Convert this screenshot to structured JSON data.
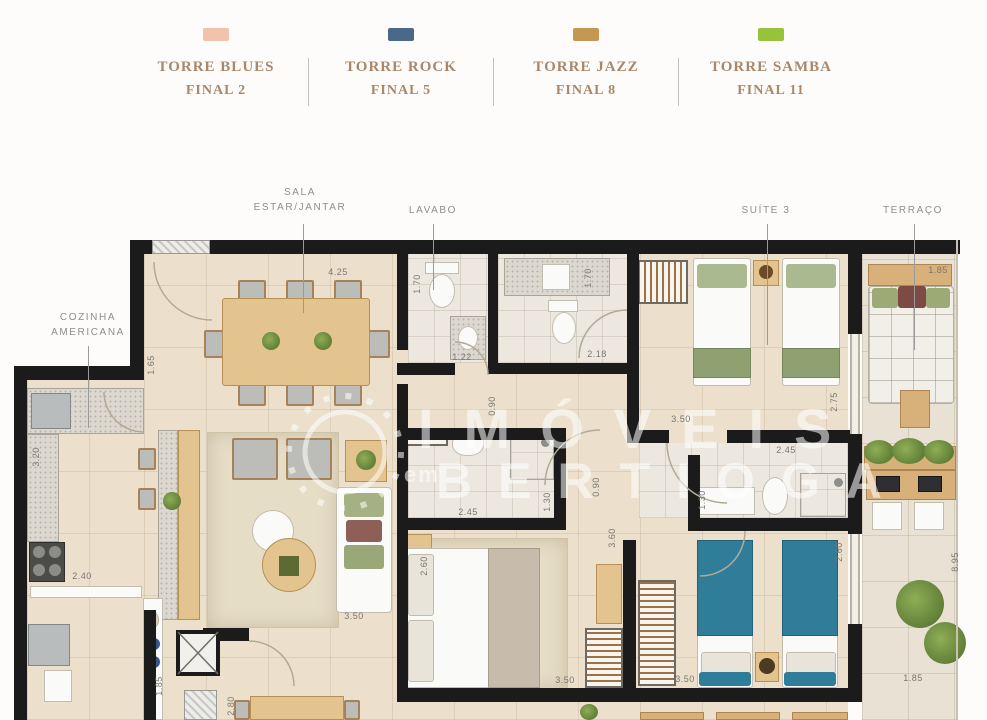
{
  "legend": {
    "items": [
      {
        "name": "TORRE BLUES",
        "final": "FINAL 2",
        "color": "#f1c2ac"
      },
      {
        "name": "TORRE ROCK",
        "final": "FINAL 5",
        "color": "#49688a"
      },
      {
        "name": "TORRE JAZZ",
        "final": "FINAL 8",
        "color": "#c49752"
      },
      {
        "name": "TORRE SAMBA",
        "final": "FINAL 11",
        "color": "#97c23c"
      }
    ]
  },
  "room_labels": [
    {
      "line1": "SALA",
      "line2": "ESTAR/JANTAR",
      "x": 300,
      "y": 185,
      "lx": 303,
      "ly1": 224,
      "ly2": 313
    },
    {
      "line1": "LAVABO",
      "line2": "",
      "x": 433,
      "y": 203,
      "lx": 433,
      "ly1": 224,
      "ly2": 290
    },
    {
      "line1": "SUÍTE 3",
      "line2": "",
      "x": 766,
      "y": 203,
      "lx": 767,
      "ly1": 224,
      "ly2": 345
    },
    {
      "line1": "TERRAÇO",
      "line2": "",
      "x": 913,
      "y": 203,
      "lx": 914,
      "ly1": 224,
      "ly2": 350
    },
    {
      "line1": "COZINHA",
      "line2": "AMERICANA",
      "x": 88,
      "y": 310,
      "lx": 88,
      "ly1": 346,
      "ly2": 428
    }
  ],
  "dimensions": [
    {
      "v": "4.25",
      "x": 338,
      "y": 272,
      "rot": 0
    },
    {
      "v": "1.70",
      "x": 417,
      "y": 284,
      "rot": 90
    },
    {
      "v": "1.22",
      "x": 462,
      "y": 357,
      "rot": 0
    },
    {
      "v": "1.65",
      "x": 151,
      "y": 365,
      "rot": 90
    },
    {
      "v": "2.18",
      "x": 597,
      "y": 354,
      "rot": 0
    },
    {
      "v": "1.70",
      "x": 588,
      "y": 278,
      "rot": 90
    },
    {
      "v": "0.90",
      "x": 492,
      "y": 406,
      "rot": 90
    },
    {
      "v": "3.20",
      "x": 36,
      "y": 457,
      "rot": 90
    },
    {
      "v": "2.40",
      "x": 82,
      "y": 576,
      "rot": 0
    },
    {
      "v": "1.85",
      "x": 159,
      "y": 686,
      "rot": 90
    },
    {
      "v": "3.50",
      "x": 354,
      "y": 616,
      "rot": 0
    },
    {
      "v": "2.80",
      "x": 231,
      "y": 706,
      "rot": 90
    },
    {
      "v": "2.45",
      "x": 468,
      "y": 512,
      "rot": 0
    },
    {
      "v": "1.30",
      "x": 547,
      "y": 502,
      "rot": 90
    },
    {
      "v": "0.90",
      "x": 596,
      "y": 487,
      "rot": 90
    },
    {
      "v": "2.60",
      "x": 424,
      "y": 566,
      "rot": 90
    },
    {
      "v": "3.60",
      "x": 612,
      "y": 538,
      "rot": 90
    },
    {
      "v": "3.50",
      "x": 565,
      "y": 680,
      "rot": 0
    },
    {
      "v": "3.50",
      "x": 681,
      "y": 419,
      "rot": 0
    },
    {
      "v": "2.75",
      "x": 834,
      "y": 402,
      "rot": 90
    },
    {
      "v": "2.45",
      "x": 786,
      "y": 450,
      "rot": 0
    },
    {
      "v": "1.30",
      "x": 702,
      "y": 500,
      "rot": 90
    },
    {
      "v": "2.60",
      "x": 839,
      "y": 552,
      "rot": 90
    },
    {
      "v": "3.50",
      "x": 685,
      "y": 679,
      "rot": 0
    },
    {
      "v": "1.85",
      "x": 938,
      "y": 270,
      "rot": 0
    },
    {
      "v": "8.95",
      "x": 955,
      "y": 562,
      "rot": 90
    },
    {
      "v": "1.85",
      "x": 913,
      "y": 678,
      "rot": 0
    }
  ],
  "watermark": {
    "line1": "IMÓVEIS",
    "prefix": "em",
    "line2": "BERTIOGA"
  }
}
